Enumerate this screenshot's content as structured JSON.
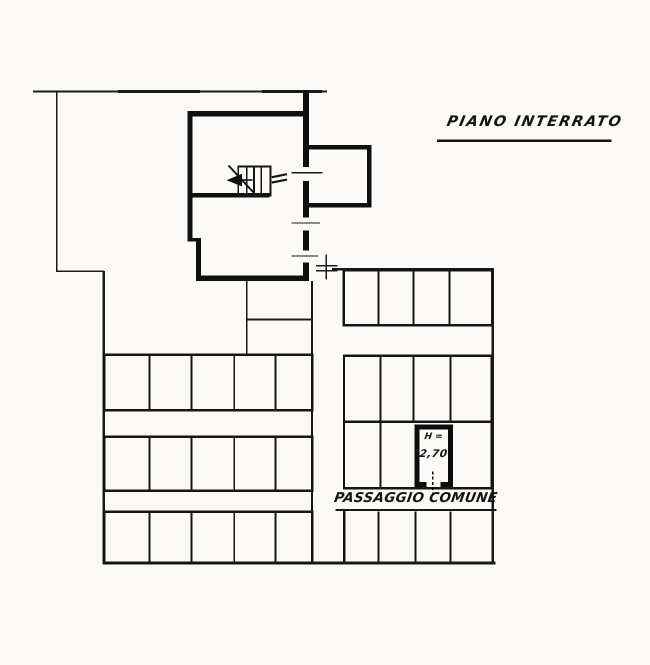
{
  "title": {
    "text": "PIANO INTERRATO"
  },
  "annotations": {
    "passage_label": "PASSAGGIO COMUNE",
    "room_height_label": "H =",
    "room_height_value": "2,70"
  },
  "colors": {
    "paper": "#fbfaf6",
    "ink": "#161616"
  },
  "plan": {
    "type": "floor-plan",
    "floor_name": "PIANO INTERRATO",
    "features": [
      "staircase",
      "annex-room",
      "common-passage",
      "storage-cell-grid"
    ],
    "storage_grid": {
      "left_rows": 3,
      "left_cells_per_row": 5,
      "right_top_row_cells": 4,
      "right_middle_rows": 2,
      "right_middle_cells_per_row": 4,
      "right_bottom_row_cells": 4
    },
    "highlighted_room": {
      "height_label": "H =",
      "height_value_m": "2,70"
    }
  }
}
